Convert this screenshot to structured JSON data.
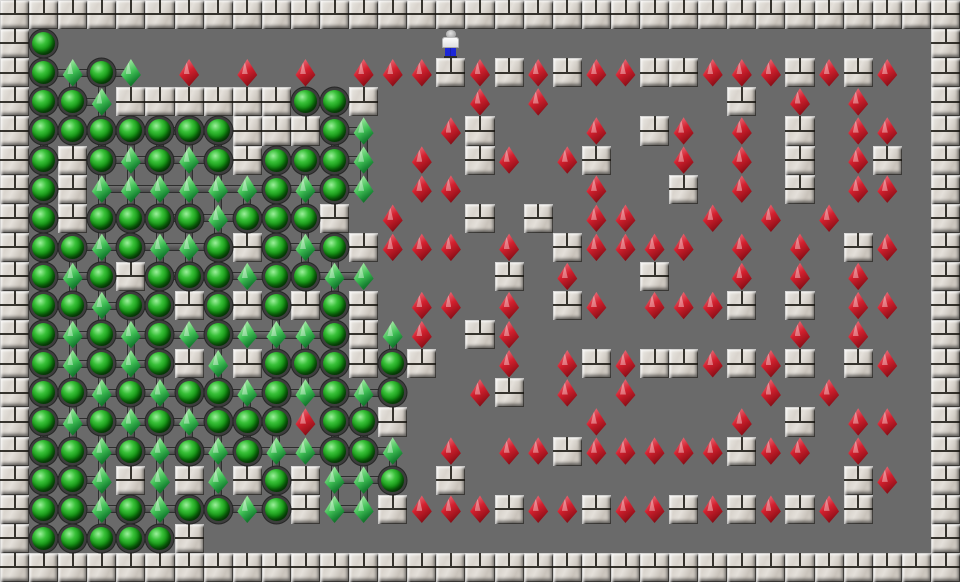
{
  "app": {
    "name": "Sokoban puzzle level",
    "description": "Grid-based Sokoban game board. Marble walls surround a gray floor. Green spheres are goal sockets linked by gray connectors, green gems are boxes already on goals, red gems are boxes not yet on goals, and the player figure stands near the top center."
  },
  "board": {
    "cols": 33,
    "rows": 20,
    "tile_width_px": 29.09,
    "tile_height_px": 29.1,
    "legend": {
      "#": "wall-tile",
      ".": "floor-tile",
      "o": "goal-socket",
      "G": "box-on-goal-green-gem",
      "R": "box-red-gem",
      "P": "player"
    },
    "rows_map": [
      "#################################",
      "#o.............P................#",
      "#oGoG.R.R.R.RRR#R#R#RR##RRR#R#R.#",
      "#ooG######oo#...R.R......#.R.R..#",
      "#ooooooo###oG..R#...R.#R.R.#.RR.#",
      "#o#oGoGo#oooG.R.#R.R#..R.R.#.R#.#",
      "#o#GGGGGGoGoG.RR....R..#.R.#.RR.#",
      "#o#ooooGooo#.R..#.#.RR..R.R.R...#",
      "#ooGoGGo#oGo#RRR.R.#RRRR.R.R.#R.#",
      "#oGo#oooGooGG....#.R..#..R.R.R..#",
      "#ooGoo#o#o#o#.RR.R.#R.RRR#.#.RR.#",
      "#oGoGoGoGGGo#GR.#R.........R.R..#",
      "#oGoGo#G#ooo#o#..R.R#R##R#R#.#R.#",
      "#ooGoGooGoGoGo..R#.R.R....R.R...#",
      "#oGoGoGoooRoo#......R....R.#.RR.#",
      "#ooGoGoGoGGooG.R.RR#RRRRR#RR.R..#",
      "#ooG#G#G#o#GGo.#.............#R.#",
      "#ooGoGooGo#GG#RRR#RR#RR#R#R#R#..#",
      "#ooooo#.........................#",
      "#################################"
    ],
    "player": {
      "col": 15,
      "row": 1
    },
    "counts": {
      "goal_sockets_empty": 104,
      "boxes_on_goal_green": 59,
      "boxes_off_goal_red": 108,
      "wall_tiles_interior": 74
    }
  },
  "colors": {
    "floor": "#6a6a6a",
    "wall_light": "#eceae6",
    "wall_mid": "#d9d4cd",
    "wall_dark": "#c9c3bb",
    "mortar": "#17150f",
    "goal_ball_light": "#9cf09c",
    "goal_ball_mid": "#129212",
    "goal_ball_dark": "#043a04",
    "goal_ring": "#3d3d3d",
    "link_bar": "#5a5a5a",
    "gem_red_light": "#f6b9be",
    "gem_red_mid": "#d2202e",
    "gem_red_dark": "#64070e",
    "gem_green_light": "#d6f7d2",
    "gem_green_mid": "#3fbf55",
    "gem_green_dark": "#0a5218",
    "player_shirt": "#ffffff",
    "player_pants": "#1c27d8",
    "player_head": "#c9c9c9"
  }
}
